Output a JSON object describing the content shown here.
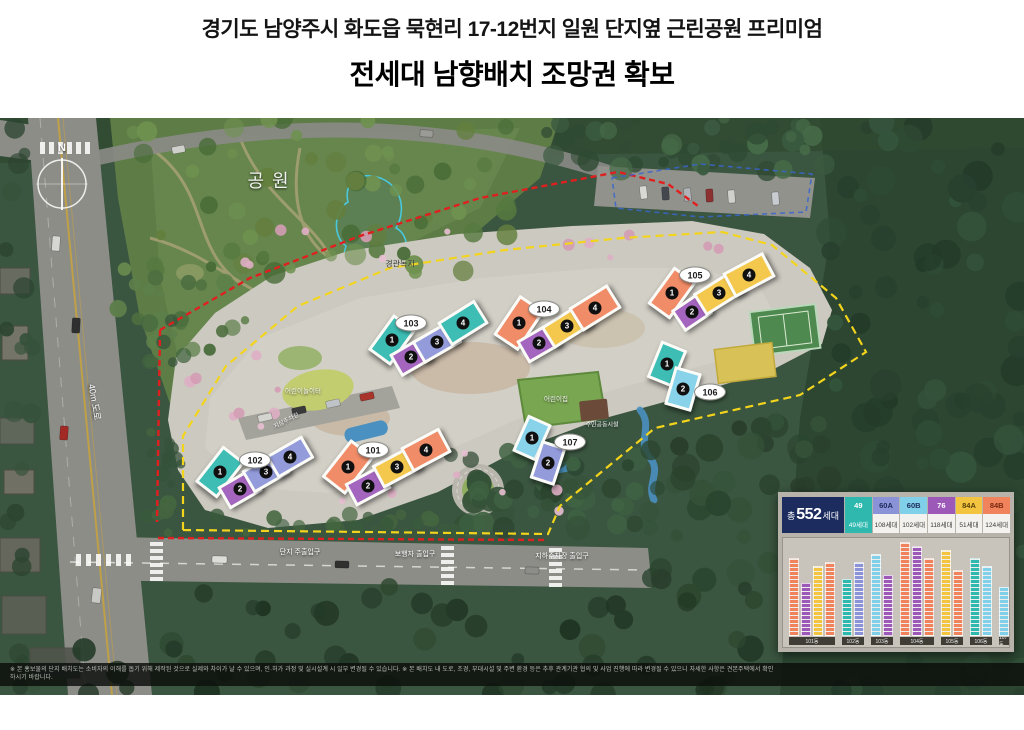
{
  "title": {
    "line1": "경기도 남양주시 화도읍 묵현리 17-12번지 일원 단지옆 근린공원 프리미엄",
    "line2": "전세대 남향배치 조망권 확보"
  },
  "map": {
    "compass": "N",
    "park_label": "공원",
    "greenbelt_label": "경관녹지",
    "road_label": "40m 도로",
    "entrance_labels": [
      "단지 주출입구",
      "보행자 출입구",
      "지하주차장 출입구"
    ],
    "facility_labels": {
      "playground": "어린이놀이터",
      "daycare": "어린이집",
      "community": "주민공동시설",
      "parking": "지상주차장"
    },
    "buildings": [
      {
        "id": "101",
        "label": "101",
        "units": [
          {
            "no": "1",
            "type": "84B"
          },
          {
            "no": "2",
            "type": "76"
          },
          {
            "no": "3",
            "type": "84A"
          },
          {
            "no": "4",
            "type": "84B"
          }
        ]
      },
      {
        "id": "102",
        "label": "102",
        "units": [
          {
            "no": "1",
            "type": "49"
          },
          {
            "no": "2",
            "type": "76"
          },
          {
            "no": "3",
            "type": "60A"
          },
          {
            "no": "4",
            "type": "60A"
          }
        ]
      },
      {
        "id": "103",
        "label": "103",
        "units": [
          {
            "no": "1",
            "type": "49"
          },
          {
            "no": "2",
            "type": "76"
          },
          {
            "no": "3",
            "type": "60A"
          },
          {
            "no": "4",
            "type": "49"
          }
        ]
      },
      {
        "id": "104",
        "label": "104",
        "units": [
          {
            "no": "1",
            "type": "84B"
          },
          {
            "no": "2",
            "type": "76"
          },
          {
            "no": "3",
            "type": "84A"
          },
          {
            "no": "4",
            "type": "84B"
          }
        ]
      },
      {
        "id": "105",
        "label": "105",
        "units": [
          {
            "no": "1",
            "type": "84B"
          },
          {
            "no": "2",
            "type": "76"
          },
          {
            "no": "3",
            "type": "84A"
          },
          {
            "no": "4",
            "type": "84A"
          }
        ]
      },
      {
        "id": "106",
        "label": "106",
        "units": [
          {
            "no": "1",
            "type": "49"
          },
          {
            "no": "2",
            "type": "60B"
          }
        ]
      },
      {
        "id": "107",
        "label": "107",
        "units": [
          {
            "no": "1",
            "type": "60B"
          },
          {
            "no": "2",
            "type": "60A"
          }
        ]
      }
    ],
    "disclaimer": "※ 본 홍보물의 단지 배치도는 소비자의 이해를 돕기 위해 제작된 것으로 실제와 차이가 날 수 있으며, 인·허가 과정 및 실시설계 시 일부 변경될 수 있습니다.  ※ 본 배치도 내 도로, 조경, 부대시설 및 주변 환경 등은 추후 관계기관 협의 및 사업 진행에 따라 변경될 수 있으니 자세한 사항은 견본주택에서 확인하시기 바랍니다."
  },
  "legend": {
    "total": {
      "prefix": "총",
      "value": "552",
      "suffix": "세대"
    },
    "types": [
      {
        "key": "49",
        "label": "49",
        "count": "49세대",
        "color": "#2eb8ae",
        "text": "#ffffff",
        "solid": true
      },
      {
        "key": "60A",
        "label": "60A",
        "count": "108세대",
        "color": "#8b93d8",
        "text": "#1e2a5a"
      },
      {
        "key": "60B",
        "label": "60B",
        "count": "102세대",
        "color": "#7fd0e8",
        "text": "#1e2a5a"
      },
      {
        "key": "76",
        "label": "76",
        "count": "118세대",
        "color": "#9c59b8",
        "text": "#ffffff"
      },
      {
        "key": "84A",
        "label": "84A",
        "count": "51세대",
        "color": "#f2c440",
        "text": "#5a4008"
      },
      {
        "key": "84B",
        "label": "84B",
        "count": "124세대",
        "color": "#f0835c",
        "text": "#7a2810"
      }
    ],
    "chart": {
      "groups": [
        {
          "dong": "101동",
          "columns": [
            {
              "type": "84B",
              "floors": 19
            },
            {
              "type": "76",
              "floors": 13
            },
            {
              "type": "84A",
              "floors": 17
            },
            {
              "type": "84B",
              "floors": 18
            }
          ]
        },
        {
          "dong": "102동",
          "columns": [
            {
              "type": "49",
              "floors": 14
            },
            {
              "type": "60A",
              "floors": 18
            }
          ]
        },
        {
          "dong": "103동",
          "columns": [
            {
              "type": "60B",
              "floors": 20
            },
            {
              "type": "76",
              "floors": 15
            }
          ]
        },
        {
          "dong": "104동",
          "columns": [
            {
              "type": "84B",
              "floors": 23
            },
            {
              "type": "76",
              "floors": 22
            },
            {
              "type": "84B",
              "floors": 19
            }
          ]
        },
        {
          "dong": "105동",
          "columns": [
            {
              "type": "84A",
              "floors": 21
            },
            {
              "type": "84B",
              "floors": 16
            }
          ]
        },
        {
          "dong": "106동",
          "columns": [
            {
              "type": "49",
              "floors": 19
            },
            {
              "type": "60B",
              "floors": 17
            }
          ]
        },
        {
          "dong": "107동",
          "columns": [
            {
              "type": "60B",
              "floors": 12
            }
          ]
        }
      ]
    }
  }
}
